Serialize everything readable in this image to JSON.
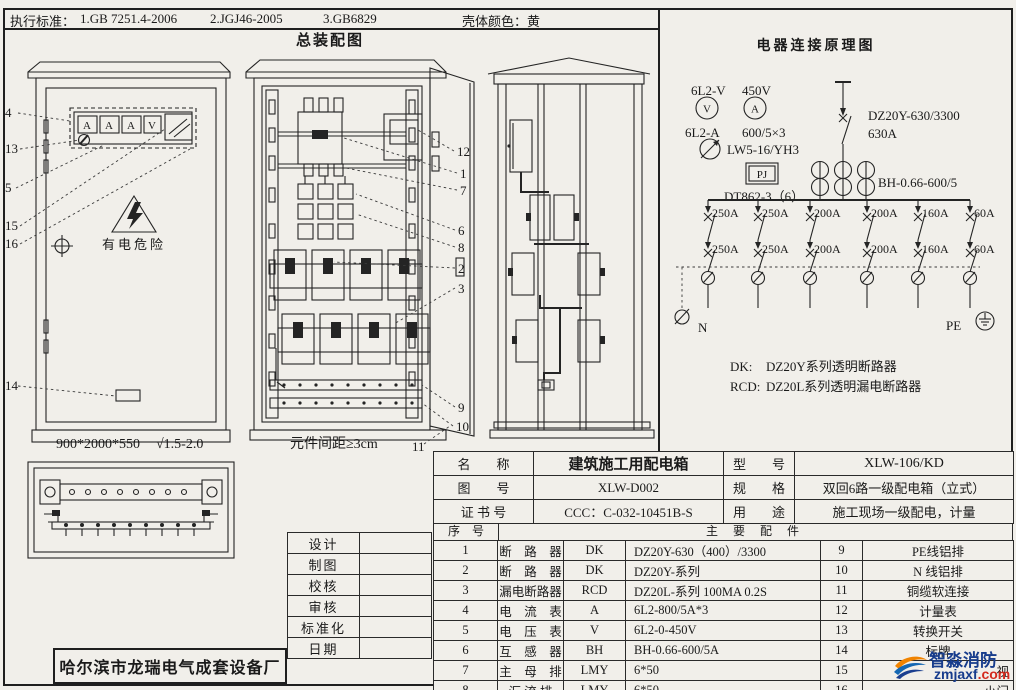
{
  "header": {
    "standards_label": "执行标准：",
    "standards": [
      "1.GB 7251.4-2006",
      "2.JGJ46-2005",
      "3.GB6829"
    ],
    "shell_color": "壳体颜色：黄",
    "assembly_title": "总装配图"
  },
  "assembly": {
    "warning_text": "有电危险",
    "meter_labels": [
      "A",
      "A",
      "A",
      "V"
    ],
    "cabinet1_size": "900*2000*550",
    "cabinet1_finish": "√1.5-2.0",
    "spacing_note": "元件间距≥3cm",
    "callouts_left": [
      "4",
      "13",
      "5",
      "15",
      "16",
      "14"
    ],
    "callouts_right": [
      "12",
      "1",
      "7",
      "6",
      "8",
      "2",
      "3",
      "9",
      "10",
      "11"
    ]
  },
  "schematic": {
    "title": "电器连接原理图",
    "voltmeter_model": "6L2-V",
    "volt_range": "450V",
    "v_glyph": "V",
    "a_glyph": "A",
    "ammeter_model": "6L2-A",
    "ct_ratio": "600/5×3",
    "changeover_model": "LW5-16/YH3",
    "pj_label": "PJ",
    "energy_meter": "DT862-3（6）",
    "main_breaker": "DZ20Y-630/3300",
    "main_rating": "630A",
    "ct_model": "BH-0.66-600/5",
    "ratings_row1": [
      "250A",
      "250A",
      "200A",
      "200A",
      "160A",
      "60A"
    ],
    "ratings_row2": [
      "250A",
      "250A",
      "200A",
      "200A",
      "160A",
      "60A"
    ],
    "n_label": "N",
    "pe_label": "PE",
    "dk_label": "DK:",
    "dk_text": "DZ20Y系列透明断路器",
    "rcd_label": "RCD:",
    "rcd_text": "DZ20L系列透明漏电断路器"
  },
  "info": {
    "name_label": "名　　称",
    "name_value": "建筑施工用配电箱",
    "model_label": "型　　号",
    "model_value": "XLW-106/KD",
    "drawing_label": "图　　号",
    "drawing_value": "XLW-D002",
    "spec_label": "规　　格",
    "spec_value": "双回6路一级配电箱（立式）",
    "cert_label": "证 书 号",
    "cert_value": "CCC：C-032-10451B-S",
    "use_label": "用　　途",
    "use_value": "施工现场一级配电，计量",
    "seq_label": "序　号",
    "parts_title": "主 要 配 件"
  },
  "parts": {
    "rows": [
      {
        "no": "1",
        "name": "断　路　器",
        "code": "DK",
        "spec": "DZ20Y-630（400）/3300",
        "no2": "9",
        "name2": "PE线铝排"
      },
      {
        "no": "2",
        "name": "断　路　器",
        "code": "DK",
        "spec": "DZ20Y-系列",
        "no2": "10",
        "name2": "N 线铝排"
      },
      {
        "no": "3",
        "name": "漏电断路器",
        "code": "RCD",
        "spec": "DZ20L-系列  100MA 0.2S",
        "no2": "11",
        "name2": "铜缆软连接"
      },
      {
        "no": "4",
        "name": "电　流　表",
        "code": "A",
        "spec": "6L2-800/5A*3",
        "no2": "12",
        "name2": "计量表"
      },
      {
        "no": "5",
        "name": "电　压　表",
        "code": "V",
        "spec": "6L2-0-450V",
        "no2": "13",
        "name2": "转换开关"
      },
      {
        "no": "6",
        "name": "互　感　器",
        "code": "BH",
        "spec": "BH-0.66-600/5A",
        "no2": "14",
        "name2": "标牌"
      },
      {
        "no": "7",
        "name": "主　母　排",
        "code": "LMY",
        "spec": "6*50",
        "no2": "15",
        "name2": "视"
      },
      {
        "no": "8",
        "name": "汇 流 排",
        "code": "LMY",
        "spec": "6*50",
        "no2": "16",
        "name2": "小门"
      }
    ]
  },
  "sign_rows": [
    "设计",
    "制图",
    "校核",
    "审核",
    "标准化",
    "日期"
  ],
  "manufacturer": "哈尔滨市龙瑞电气成套设备厂",
  "watermark": {
    "name": "智淼消防",
    "domain": "zmjaxf",
    "tld": ".com"
  }
}
